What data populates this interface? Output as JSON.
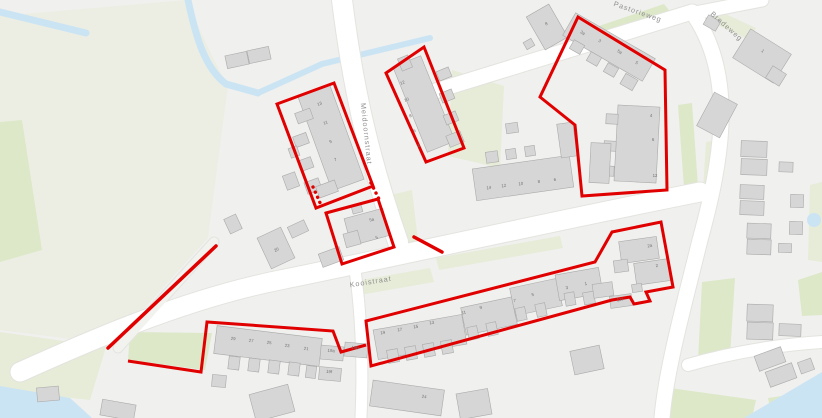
{
  "map": {
    "canvas": {
      "w": 822,
      "h": 418,
      "bg": "#f0f0ee"
    },
    "palette": {
      "water": "#cbe4f3",
      "road": "#ffffff",
      "road_casing": "#e3e3df",
      "path": "#f2f2ef",
      "building_fill": "#d6d6d6",
      "building_stroke": "#aaaaaa",
      "boundary_red": "#e10000",
      "street_text": "#8f8f8f",
      "number_text": "#6f6f6f",
      "field": "#eceee3",
      "green": "#dde8c9",
      "green_soft": "#e6ecd7"
    },
    "streets": [
      {
        "name": "Pastorieweg",
        "x": 637,
        "y": 14,
        "r": 19
      },
      {
        "name": "Bredeweg",
        "x": 725,
        "y": 28,
        "r": 42
      },
      {
        "name": "Meidoornstraat",
        "x": 364,
        "y": 134,
        "r": 84
      },
      {
        "name": "Kooistraat",
        "x": 371,
        "y": 284,
        "r": -9
      }
    ],
    "fields": [
      {
        "points": "0,16 186,0 214,60 228,86 208,238 112,344 0,330",
        "tone": "field"
      }
    ],
    "greens": [
      {
        "points": "0,122 22,120 42,250 0,262",
        "tone": "green"
      },
      {
        "points": "130,332 212,333 205,370 128,360",
        "tone": "green"
      },
      {
        "points": "0,332 106,347 90,400 0,390",
        "tone": "green_soft"
      },
      {
        "points": "593,28 664,4 672,14 601,40",
        "tone": "green"
      },
      {
        "points": "678,105 692,103 698,186 684,188",
        "tone": "green"
      },
      {
        "points": "706,142 718,140 714,208 702,206",
        "tone": "green_soft"
      },
      {
        "points": "452,70 504,86 500,168 448,156",
        "tone": "green_soft"
      },
      {
        "points": "386,196 412,190 420,258 395,263",
        "tone": "green_soft"
      },
      {
        "points": "436,258 560,236 563,248 439,270",
        "tone": "green_soft"
      },
      {
        "points": "350,282 430,268 434,282 354,296",
        "tone": "green_soft"
      },
      {
        "points": "702,282 735,278 730,356 698,360",
        "tone": "green"
      },
      {
        "points": "798,280 822,272 822,315 802,316",
        "tone": "green"
      },
      {
        "points": "670,388 756,400 752,418 668,418",
        "tone": "green"
      },
      {
        "points": "768,398 822,390 822,418 772,418",
        "tone": "green"
      },
      {
        "points": "810,185 822,182 822,262 808,260",
        "tone": "green_soft"
      },
      {
        "points": "708,6 756,28 750,40 702,18",
        "tone": "green_soft"
      }
    ],
    "water": {
      "strokes": [
        {
          "d": "M0,12 L86,33",
          "w": 7
        },
        {
          "d": "M188,0 C196,38 205,68 226,84 L258,93",
          "w": 7
        },
        {
          "d": "M258,93 L322,64 L430,38",
          "w": 6
        }
      ],
      "polys": [
        "0,386 70,398 92,418 0,418",
        "744,418 822,372 822,418"
      ],
      "pond": {
        "cx": 814,
        "cy": 220,
        "r": 7
      }
    },
    "roads": [
      {
        "d": "M342,0 C352,80 366,150 398,242",
        "w": 20,
        "kind": "road"
      },
      {
        "d": "M20,372 C80,345 180,300 280,280 C380,260 520,228 700,192",
        "w": 19,
        "kind": "road"
      },
      {
        "d": "M432,92 L692,12",
        "w": 15,
        "kind": "road"
      },
      {
        "d": "M690,14 L762,0",
        "w": 13,
        "kind": "road"
      },
      {
        "d": "M692,12 C737,75 722,160 700,240 C684,305 666,370 662,418",
        "w": 15,
        "kind": "road"
      },
      {
        "d": "M688,365 C740,350 790,344 822,342",
        "w": 12,
        "kind": "road"
      },
      {
        "d": "M355,270 C362,320 363,370 361,418",
        "w": 11,
        "kind": "road"
      },
      {
        "d": "M118,348 L214,242",
        "w": 9,
        "kind": "path"
      }
    ],
    "buildings": [
      [
        237,
        60,
        22,
        13,
        -12
      ],
      [
        259,
        55,
        22,
        13,
        -12
      ],
      [
        547,
        27,
        26,
        38,
        -30
      ],
      [
        529,
        44,
        9,
        8,
        -30
      ],
      [
        331,
        138,
        34,
        100,
        -20
      ],
      [
        304,
        116,
        16,
        11,
        -20
      ],
      [
        301,
        140,
        14,
        11,
        -20
      ],
      [
        306,
        164,
        13,
        11,
        -20
      ],
      [
        313,
        186,
        15,
        12,
        -20
      ],
      [
        294,
        152,
        9,
        10,
        -20
      ],
      [
        291,
        181,
        13,
        15,
        -20
      ],
      [
        327,
        189,
        20,
        12,
        -20
      ],
      [
        424,
        104,
        30,
        92,
        -22
      ],
      [
        444,
        74,
        13,
        10,
        -22
      ],
      [
        447,
        96,
        13,
        10,
        -22
      ],
      [
        451,
        118,
        13,
        10,
        -22
      ],
      [
        455,
        139,
        15,
        12,
        -22
      ],
      [
        405,
        63,
        11,
        13,
        -22
      ],
      [
        367,
        227,
        40,
        28,
        -15
      ],
      [
        352,
        239,
        15,
        14,
        -15
      ],
      [
        357,
        209,
        10,
        8,
        -15
      ],
      [
        331,
        257,
        22,
        14,
        -20
      ],
      [
        276,
        248,
        26,
        34,
        -25
      ],
      [
        233,
        224,
        13,
        16,
        -25
      ],
      [
        298,
        229,
        18,
        12,
        -25
      ],
      [
        523,
        178,
        98,
        32,
        -8
      ],
      [
        492,
        157,
        12,
        11,
        -8
      ],
      [
        511,
        154,
        10,
        10,
        -8
      ],
      [
        530,
        151,
        10,
        10,
        -8
      ],
      [
        567,
        140,
        16,
        34,
        -8
      ],
      [
        512,
        128,
        12,
        10,
        -8
      ],
      [
        609,
        47,
        92,
        26,
        30
      ],
      [
        577,
        47,
        12,
        10,
        30
      ],
      [
        594,
        59,
        12,
        10,
        30
      ],
      [
        611,
        70,
        12,
        10,
        30
      ],
      [
        629,
        82,
        14,
        12,
        30
      ],
      [
        637,
        144,
        42,
        76,
        3
      ],
      [
        612,
        119,
        12,
        10,
        3
      ],
      [
        610,
        146,
        12,
        10,
        3
      ],
      [
        608,
        171,
        12,
        10,
        3
      ],
      [
        600,
        163,
        20,
        40,
        3
      ],
      [
        712,
        23,
        14,
        11,
        30
      ],
      [
        762,
        56,
        48,
        34,
        32
      ],
      [
        776,
        76,
        16,
        14,
        32
      ],
      [
        717,
        115,
        26,
        38,
        28
      ],
      [
        754,
        149,
        26,
        16,
        2
      ],
      [
        754,
        167,
        26,
        16,
        2
      ],
      [
        786,
        167,
        14,
        10,
        2
      ],
      [
        752,
        192,
        24,
        14,
        2
      ],
      [
        752,
        208,
        24,
        14,
        2
      ],
      [
        797,
        201,
        13,
        13,
        2
      ],
      [
        796,
        228,
        13,
        13,
        2
      ],
      [
        759,
        231,
        24,
        15,
        2
      ],
      [
        759,
        247,
        24,
        15,
        2
      ],
      [
        785,
        248,
        13,
        9,
        2
      ],
      [
        420,
        337,
        90,
        30,
        -10
      ],
      [
        393,
        356,
        11,
        13,
        -10
      ],
      [
        411,
        353,
        11,
        13,
        -10
      ],
      [
        429,
        350,
        11,
        13,
        -10
      ],
      [
        447,
        347,
        11,
        13,
        -10
      ],
      [
        489,
        316,
        52,
        28,
        -12
      ],
      [
        473,
        333,
        10,
        13,
        -12
      ],
      [
        492,
        329,
        10,
        13,
        -12
      ],
      [
        536,
        297,
        48,
        28,
        -12
      ],
      [
        521,
        314,
        10,
        13,
        -12
      ],
      [
        541,
        310,
        10,
        13,
        -12
      ],
      [
        579,
        284,
        44,
        26,
        -10
      ],
      [
        570,
        299,
        10,
        13,
        -10
      ],
      [
        589,
        298,
        11,
        12,
        -10
      ],
      [
        639,
        250,
        38,
        22,
        -8
      ],
      [
        652,
        272,
        34,
        22,
        -8
      ],
      [
        621,
        266,
        14,
        12,
        -8
      ],
      [
        637,
        288,
        10,
        8,
        -8
      ],
      [
        621,
        301,
        22,
        12,
        -8
      ],
      [
        603,
        290,
        20,
        14,
        -8
      ],
      [
        268,
        346,
        106,
        28,
        7
      ],
      [
        234,
        363,
        11,
        13,
        7
      ],
      [
        254,
        365,
        11,
        13,
        7
      ],
      [
        274,
        367,
        11,
        13,
        7
      ],
      [
        294,
        369,
        11,
        13,
        7
      ],
      [
        311,
        372,
        10,
        12,
        7
      ],
      [
        332,
        353,
        23,
        14,
        5
      ],
      [
        356,
        350,
        23,
        14,
        5
      ],
      [
        330,
        374,
        22,
        13,
        5
      ],
      [
        407,
        398,
        72,
        26,
        8
      ],
      [
        272,
        403,
        40,
        28,
        -15
      ],
      [
        474,
        404,
        32,
        26,
        -10
      ],
      [
        587,
        360,
        30,
        24,
        -12
      ],
      [
        219,
        381,
        14,
        12,
        5
      ],
      [
        118,
        410,
        34,
        16,
        10
      ],
      [
        48,
        394,
        22,
        14,
        -5
      ],
      [
        760,
        313,
        26,
        17,
        2
      ],
      [
        760,
        331,
        26,
        17,
        2
      ],
      [
        790,
        330,
        22,
        12,
        2
      ],
      [
        770,
        359,
        28,
        16,
        -20
      ],
      [
        781,
        375,
        28,
        16,
        -20
      ],
      [
        806,
        366,
        14,
        12,
        -20
      ]
    ],
    "house_numbers": [
      [
        "13",
        320,
        105,
        -20
      ],
      [
        "11",
        326,
        124,
        -20
      ],
      [
        "9",
        331,
        143,
        -20
      ],
      [
        "7",
        336,
        161,
        -20
      ],
      [
        "12",
        403,
        84,
        -22
      ],
      [
        "10",
        407,
        101,
        -22
      ],
      [
        "8",
        411,
        117,
        -22
      ],
      [
        "6",
        415,
        132,
        -22
      ],
      [
        "4",
        419,
        147,
        -22
      ],
      [
        "5a",
        372,
        221,
        -15
      ],
      [
        "5",
        377,
        239,
        -15
      ],
      [
        "3a",
        582,
        34,
        30
      ],
      [
        "3",
        599,
        42,
        30
      ],
      [
        "5a",
        619,
        53,
        30
      ],
      [
        "5",
        636,
        64,
        30
      ],
      [
        "4",
        651,
        117,
        0
      ],
      [
        "6",
        653,
        141,
        0
      ],
      [
        "12",
        655,
        177,
        0
      ],
      [
        "14",
        489,
        189,
        -8
      ],
      [
        "12",
        504,
        187,
        -8
      ],
      [
        "10",
        521,
        185,
        -8
      ],
      [
        "8",
        539,
        183,
        -8
      ],
      [
        "6",
        555,
        181,
        -8
      ],
      [
        "20",
        277,
        251,
        -25
      ],
      [
        "8",
        547,
        25,
        -30
      ],
      [
        "1",
        762,
        52,
        35
      ],
      [
        "19",
        383,
        334,
        -10
      ],
      [
        "17",
        400,
        331,
        -10
      ],
      [
        "15",
        416,
        328,
        -10
      ],
      [
        "13",
        432,
        324,
        -10
      ],
      [
        "11",
        464,
        314,
        -12
      ],
      [
        "9",
        481,
        309,
        -12
      ],
      [
        "7",
        515,
        302,
        -12
      ],
      [
        "5",
        533,
        296,
        -12
      ],
      [
        "3",
        567,
        289,
        -10
      ],
      [
        "1",
        586,
        285,
        -10
      ],
      [
        "2a",
        650,
        247,
        -8
      ],
      [
        "2",
        657,
        267,
        -8
      ],
      [
        "12f",
        620,
        301,
        -8
      ],
      [
        "29",
        233,
        340,
        7
      ],
      [
        "27",
        251,
        342,
        7
      ],
      [
        "25",
        269,
        344,
        7
      ],
      [
        "23",
        287,
        347,
        7
      ],
      [
        "21",
        306,
        350,
        7
      ],
      [
        "19a",
        331,
        352,
        5
      ],
      [
        "19b",
        355,
        349,
        5
      ],
      [
        "19f",
        329,
        373,
        5
      ],
      [
        "24",
        424,
        398,
        8
      ]
    ],
    "red_areas": [
      {
        "kind": "polygon",
        "points": "277,104 334,83 373,186 316,208"
      },
      {
        "kind": "polygon",
        "points": "326,213 378,199 394,247 342,264"
      },
      {
        "kind": "polygon",
        "points": "386,73 424,47 464,148 426,162"
      },
      {
        "kind": "polygon",
        "points": "578,17 665,70 667,190 582,196 575,125 540,97"
      },
      {
        "kind": "polygon",
        "points": "366,321 595,262 612,232 661,222 673,287 646,292 650,301 634,304 630,297 612,300 371,366"
      },
      {
        "kind": "polyline",
        "points": "128,361 201,372 207,322 333,331 341,352 366,345"
      },
      {
        "kind": "line",
        "points": "108,348 216,246"
      },
      {
        "kind": "line",
        "points": "414,237 442,252"
      },
      {
        "kind": "dots",
        "points": "313,187 317,196 321,205"
      },
      {
        "kind": "dots",
        "points": "371,183 375,191 379,199"
      }
    ]
  }
}
